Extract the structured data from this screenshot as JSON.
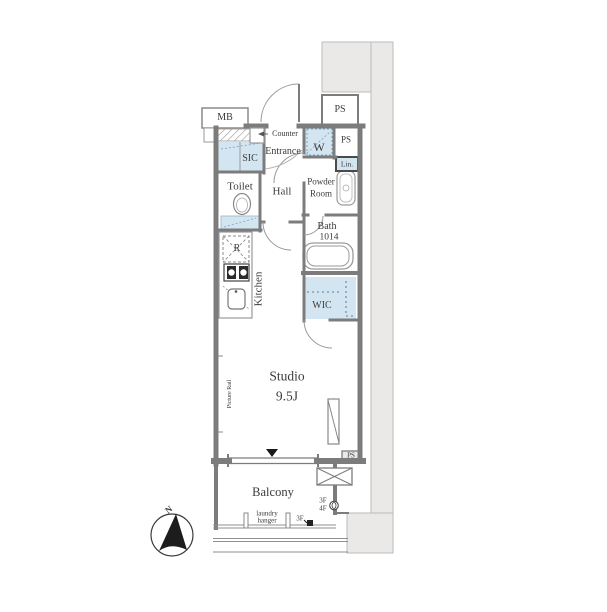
{
  "colors": {
    "wall": "#7c7c7c",
    "common_area_gray": "#ebe9e7",
    "storage_blue": "#d2e5f1",
    "fixture_line": "#9a9a9a",
    "text": "#3b3b3b"
  },
  "rooms": {
    "mb": "MB",
    "ps_top": "PS",
    "counter": "Counter",
    "entrance": "Entrance",
    "sic": "SIC",
    "washer": "W",
    "ps_right": "PS",
    "linen": "Lin.",
    "toilet": "Toilet",
    "hall": "Hall",
    "powder_line1": "Powder",
    "powder_line2": "Room",
    "bath": "Bath",
    "bath_size": "1014",
    "fridge": "R",
    "kitchen": "Kitchen",
    "wic": "WIC",
    "picture_rail": "Picture Rail",
    "studio": "Studio",
    "studio_size": "9.5J",
    "ps_bottom": "PS",
    "balcony": "Balcony",
    "floor_note_3f": "3F",
    "floor_note_4f": "4F",
    "laundry_line1": "laundry",
    "laundry_line2": "hanger",
    "faucet_floor_3f": "3F"
  },
  "compass": {
    "north_label": "N"
  }
}
